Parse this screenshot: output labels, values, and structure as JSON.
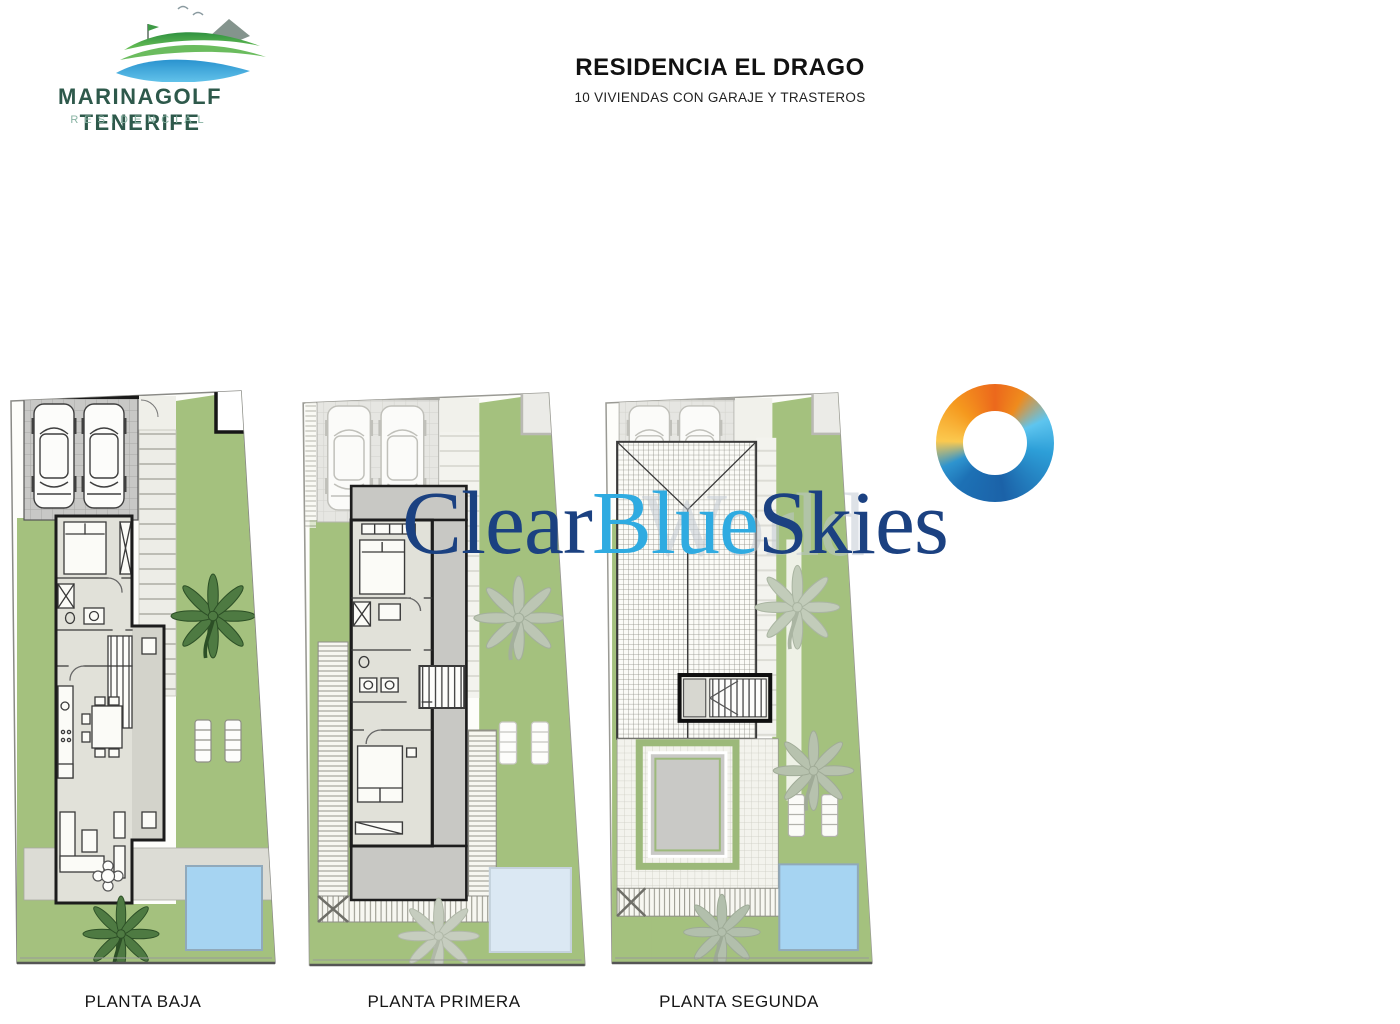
{
  "header": {
    "brand": {
      "name": "MARINAGOLF TENERIFE",
      "tagline": "RESIDENCIAL"
    },
    "title": "RESIDENCIA EL DRAGO",
    "subtitle": "10 VIVIENDAS CON GARAJE Y TRASTEROS"
  },
  "plans": [
    {
      "label": "PLANTA BAJA"
    },
    {
      "label": "PLANTA PRIMERA"
    },
    {
      "label": "PLANTA SEGUNDA"
    }
  ],
  "watermark": {
    "part1": "Clear",
    "part2": "Blue",
    "part3": "Skies",
    "ghost_text": "World"
  },
  "icons": {
    "brand_logo": "golf-waves-mountain-flag",
    "agency_logo": "orange-blue-swirl-ring",
    "palm_tree": "eight-frond-palm"
  },
  "colors": {
    "watermark_navy": "#1b4181",
    "watermark_light_blue": "#2fabe1",
    "garden_green": "#a4c17e",
    "pool_blue": "#a6d4f2",
    "brand_green": "#2e594b",
    "brand_tagline_green": "#87b2a2",
    "wall_dark": "#1c1c1c",
    "tile_gray": "#c8c8c6"
  }
}
